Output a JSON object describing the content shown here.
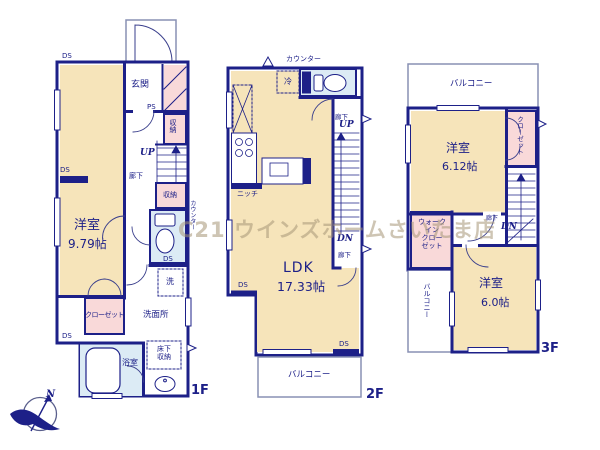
{
  "watermark": "C21 ウインズホームさいたま店",
  "compass": {
    "north": "N"
  },
  "colors": {
    "wall": "#1d2088",
    "room_beige": "#f6e4ba",
    "closet_pink": "#f9d9d9",
    "wet_blue": "#dcebf5"
  },
  "floor1": {
    "name": "1F",
    "labels": {
      "ds_top": "DS",
      "genkan": "玄関",
      "ps": "PS",
      "storage_upper": "収納",
      "up": "UP",
      "hall": "廊下",
      "ds_mid": "DS",
      "storage_lower": "収納",
      "counter": "カウンター",
      "room": "洋室",
      "room_size": "9.79帖",
      "ds_toilet": "DS",
      "laundry": "洗",
      "closet": "クローゼット",
      "washroom": "洗面所",
      "ds_bottom": "DS",
      "bath": "浴室",
      "underfloor": "床下\n収納"
    }
  },
  "floor2": {
    "name": "2F",
    "labels": {
      "counter": "カウンター",
      "fridge": "冷",
      "hall_upper": "廊下",
      "up": "UP",
      "niche": "ニッチ",
      "dn": "DN",
      "hall_lower": "廊下",
      "ldk": "LDK",
      "ldk_size": "17.33帖",
      "ds_left": "DS",
      "ds_right": "DS",
      "balcony": "バルコニー"
    }
  },
  "floor3": {
    "name": "3F",
    "labels": {
      "balcony_top": "バルコニー",
      "room1": "洋室",
      "room1_size": "6.12帖",
      "closet": "クローゼット",
      "wic": "ウォーク\nイン\nクロー\nゼット",
      "hall": "廊下",
      "dn": "DN",
      "room2": "洋室",
      "room2_size": "6.0帖",
      "balcony_left": "バルコニー"
    }
  }
}
